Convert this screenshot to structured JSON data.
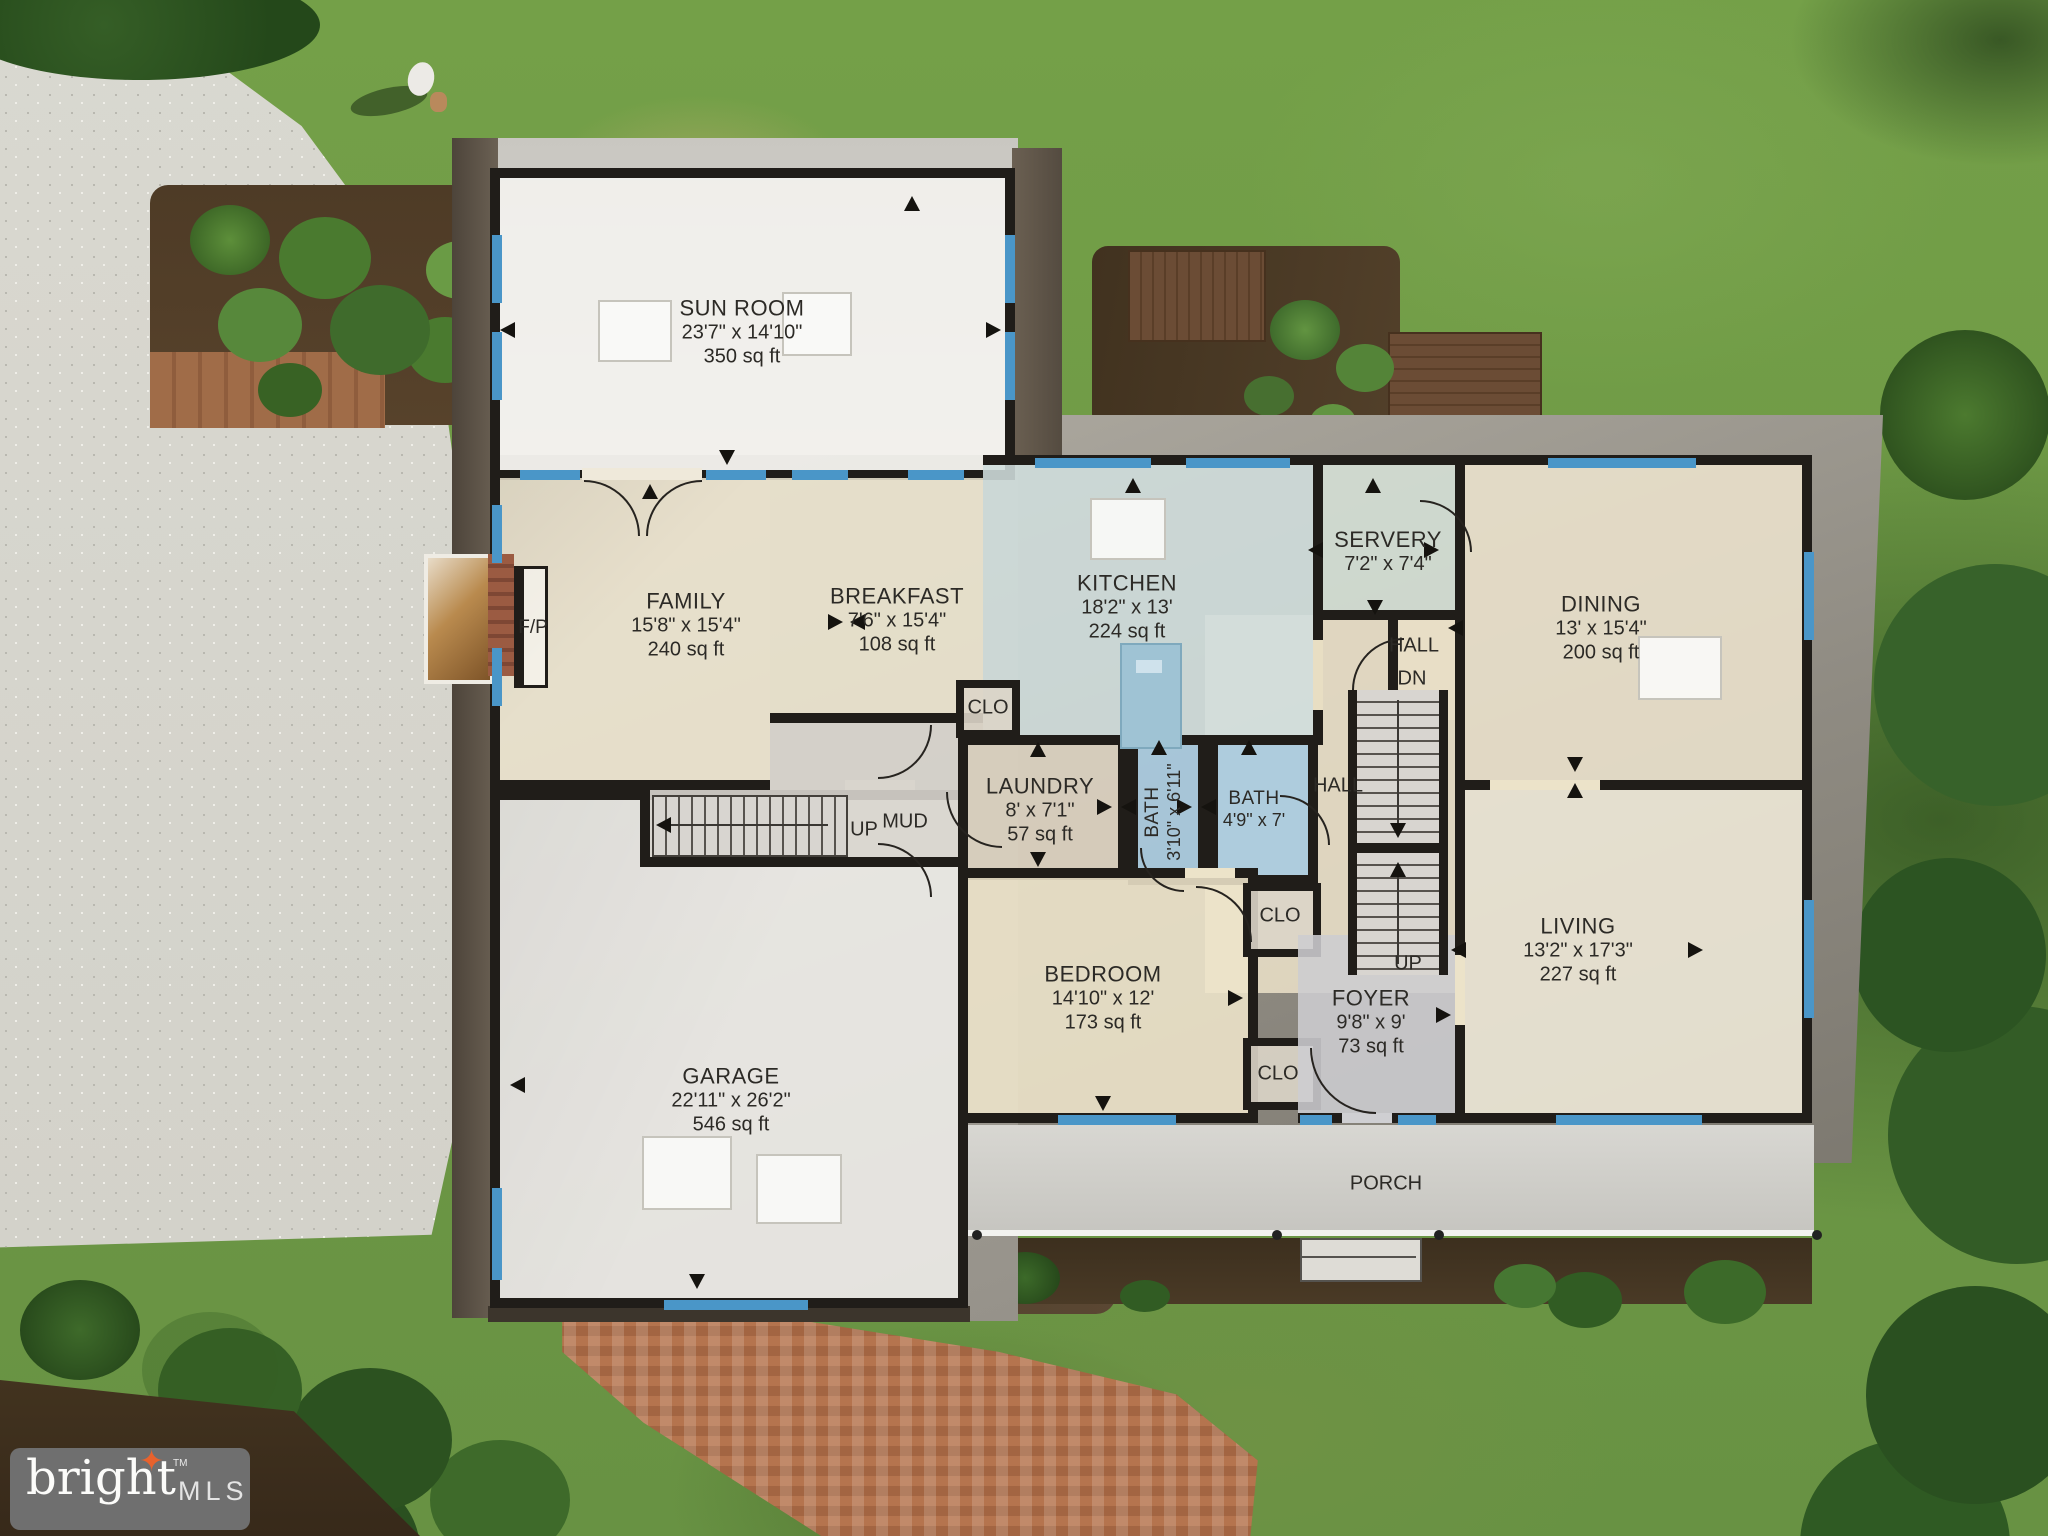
{
  "branding": {
    "logo_text": "bright",
    "tm": "TM",
    "mls": "MLS",
    "star_icon": "✦"
  },
  "floor_plan": {
    "rooms": [
      {
        "id": "sun_room",
        "name": "SUN ROOM",
        "dims": "23'7\" x 14'10\"",
        "area": "350 sq ft"
      },
      {
        "id": "family",
        "name": "FAMILY",
        "dims": "15'8\" x 15'4\"",
        "area": "240 sq ft"
      },
      {
        "id": "breakfast",
        "name": "BREAKFAST",
        "dims": "7'6\" x 15'4\"",
        "area": "108 sq ft"
      },
      {
        "id": "kitchen",
        "name": "KITCHEN",
        "dims": "18'2\" x 13'",
        "area": "224 sq ft"
      },
      {
        "id": "servery",
        "name": "SERVERY",
        "dims": "7'2\" x 7'4\"",
        "area": ""
      },
      {
        "id": "dining",
        "name": "DINING",
        "dims": "13' x 15'4\"",
        "area": "200 sq ft"
      },
      {
        "id": "laundry",
        "name": "LAUNDRY",
        "dims": "8' x 7'1\"",
        "area": "57 sq ft"
      },
      {
        "id": "bath_small",
        "name": "BATH",
        "dims": "3'10\" x 6'11\"",
        "area": ""
      },
      {
        "id": "bath_hall",
        "name": "BATH",
        "dims": "4'9\" x 7'",
        "area": ""
      },
      {
        "id": "bedroom",
        "name": "BEDROOM",
        "dims": "14'10\" x 12'",
        "area": "173 sq ft"
      },
      {
        "id": "foyer",
        "name": "FOYER",
        "dims": "9'8\" x 9'",
        "area": "73 sq ft"
      },
      {
        "id": "living",
        "name": "LIVING",
        "dims": "13'2\" x 17'3\"",
        "area": "227 sq ft"
      },
      {
        "id": "garage",
        "name": "GARAGE",
        "dims": "22'11\" x 26'2\"",
        "area": "546 sq ft"
      }
    ],
    "labels": {
      "hall": "HALL",
      "dn": "DN",
      "up": "UP",
      "mud": "MUD",
      "clo": "CLO",
      "porch": "PORCH",
      "fireplace": "F/P"
    }
  },
  "colors": {
    "wall": "#201d19",
    "window_accent": "#4a96c8",
    "logo_bg": "#6f6f6f",
    "logo_star": "#e8622d"
  }
}
